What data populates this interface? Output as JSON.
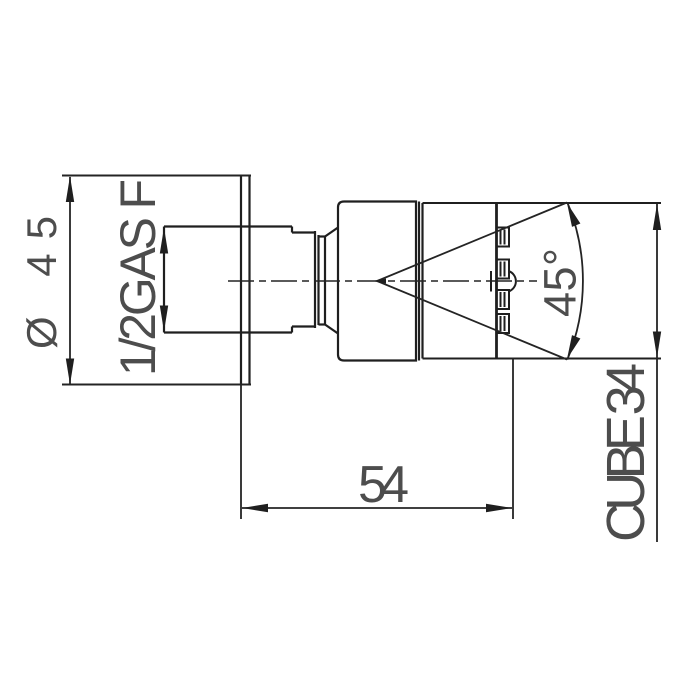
{
  "drawing": {
    "type": "technical-dimension-drawing",
    "dimensions": {
      "diameter": "Ø 45",
      "thread": "1/2GAS F",
      "spray_angle": "45°",
      "depth": "54",
      "product_height": "CUBE 34"
    },
    "colors": {
      "line": "#1f1f1f",
      "text": "#4d4d4d",
      "background": "#ffffff"
    }
  }
}
